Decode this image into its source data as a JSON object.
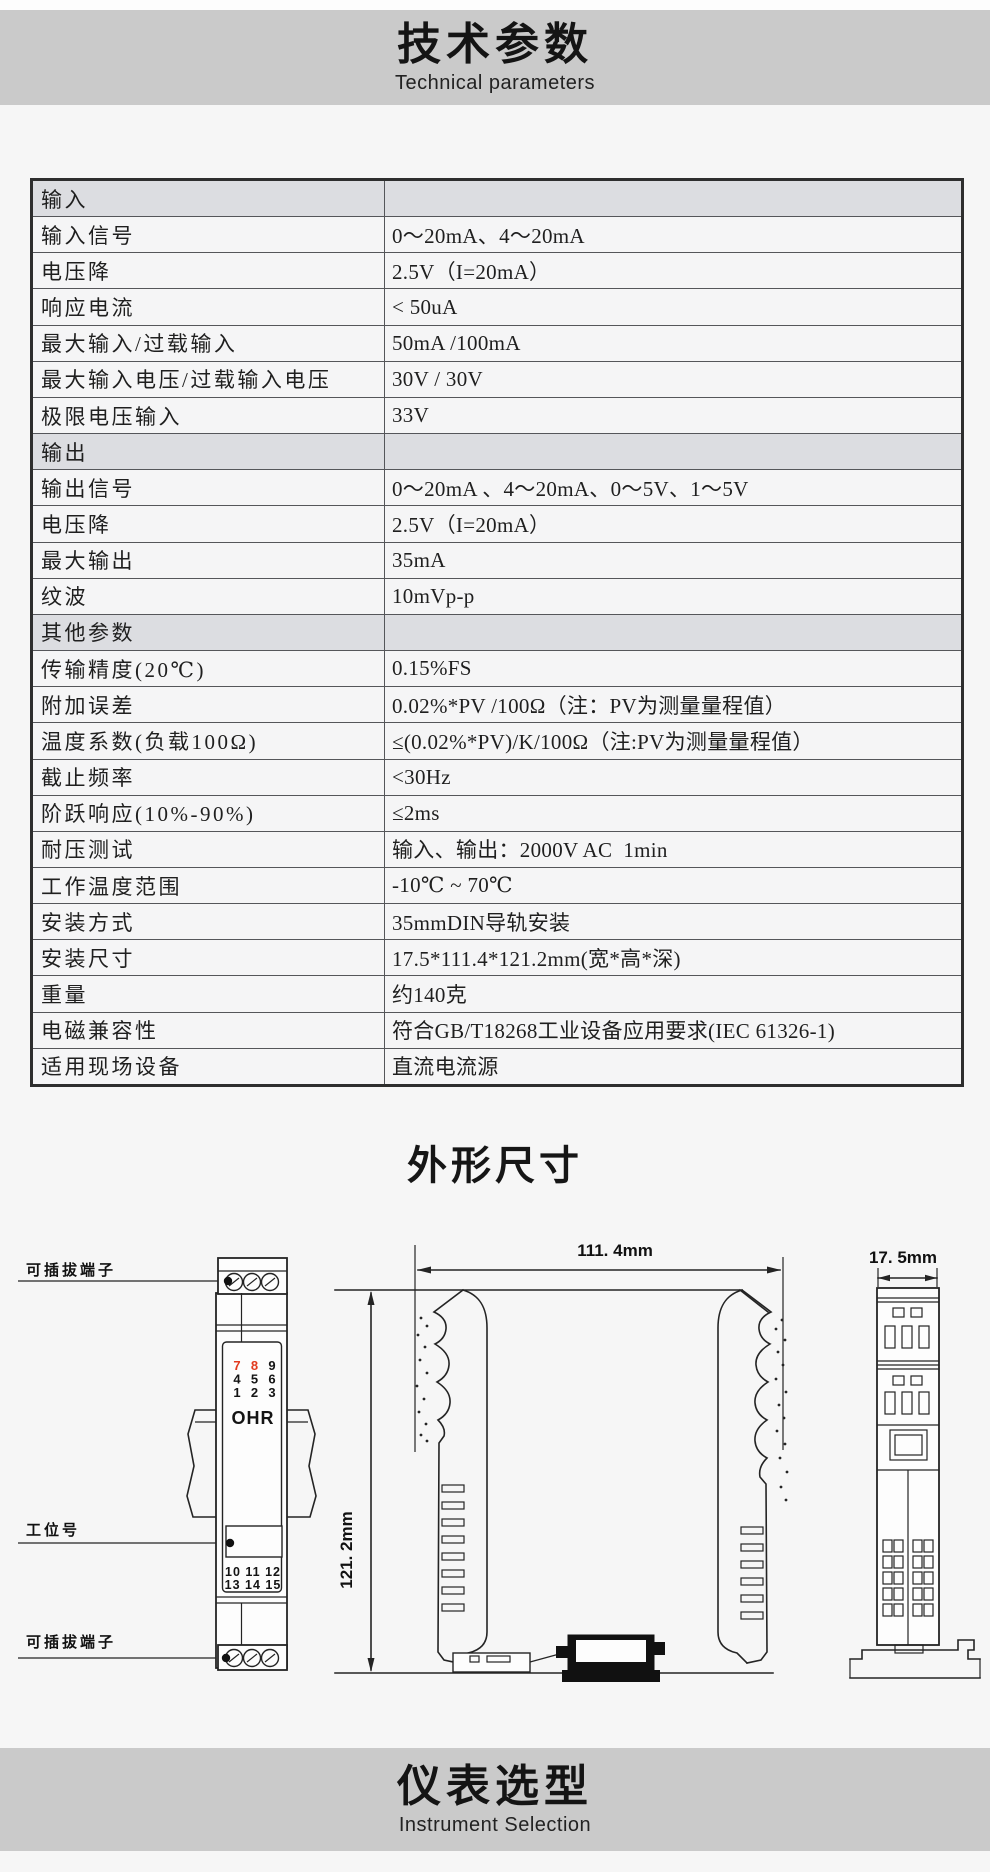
{
  "colors": {
    "page-bg": "#f6f6f6",
    "banner-bg": "#cacaca",
    "row-bg": "#f5f5f6",
    "section-bg": "#dcdde1",
    "line": "#55565a",
    "heavy": "#2e2e2e",
    "red": "#e23a1e",
    "draw": "#242424",
    "ink": "#1c1c1c"
  },
  "header": {
    "title": "技术参数",
    "subtitle": "Technical parameters"
  },
  "outline_section": {
    "title": "外形尺寸"
  },
  "selection_section": {
    "title": "仪表选型",
    "subtitle": "Instrument Selection"
  },
  "spec_table": {
    "rows": [
      {
        "type": "section",
        "label": "输入",
        "value": ""
      },
      {
        "type": "data",
        "label": "输入信号",
        "value": "0～20mA、4～20mA"
      },
      {
        "type": "data",
        "label": "电压降",
        "value": "2.5V（I=20mA）"
      },
      {
        "type": "data",
        "label": "响应电流",
        "value": "< 50uA"
      },
      {
        "type": "data",
        "label": "最大输入/过载输入",
        "value": "50mA /100mA"
      },
      {
        "type": "data",
        "label": "最大输入电压/过载输入电压",
        "value": "30V / 30V"
      },
      {
        "type": "data",
        "label": "极限电压输入",
        "value": "33V"
      },
      {
        "type": "section",
        "label": "输出",
        "value": ""
      },
      {
        "type": "data",
        "label": "输出信号",
        "value": "0～20mA 、4～20mA、0～5V、1～5V"
      },
      {
        "type": "data",
        "label": "电压降",
        "value": "2.5V（I=20mA）"
      },
      {
        "type": "data",
        "label": "最大输出",
        "value": "35mA"
      },
      {
        "type": "data",
        "label": "纹波",
        "value": "10mVp-p"
      },
      {
        "type": "section",
        "label": "其他参数",
        "value": ""
      },
      {
        "type": "data",
        "label": "传输精度(20℃)",
        "value": "0.15%FS"
      },
      {
        "type": "data",
        "label": "附加误差",
        "value": "0.02%*PV /100Ω（注：PV为测量量程值）"
      },
      {
        "type": "data",
        "label": "温度系数(负载100Ω)",
        "value": "≤(0.02%*PV)/K/100Ω（注:PV为测量量程值）"
      },
      {
        "type": "data",
        "label": "截止频率",
        "value": "<30Hz"
      },
      {
        "type": "data",
        "label": "阶跃响应(10%-90%)",
        "value": "≤2ms"
      },
      {
        "type": "data",
        "label": "耐压测试",
        "value": "输入、输出：2000V AC  1min"
      },
      {
        "type": "data",
        "label": "工作温度范围",
        "value": "-10℃ ~ 70℃"
      },
      {
        "type": "data",
        "label": "安装方式",
        "value": "35mmDIN导轨安装"
      },
      {
        "type": "data",
        "label": "安装尺寸",
        "value": "17.5*111.4*121.2mm(宽*高*深)"
      },
      {
        "type": "data",
        "label": "重量",
        "value": "约140克"
      },
      {
        "type": "data",
        "label": "电磁兼容性",
        "value": "符合GB/T18268工业设备应用要求(IEC 61326-1)"
      },
      {
        "type": "data",
        "label": "适用现场设备",
        "value": "直流电流源"
      }
    ]
  },
  "drawings": {
    "front_view": {
      "label_top_terminal": "可插拔端子",
      "label_tag": "工位号",
      "label_bottom_terminal": "可插拔端子",
      "brand": "OHR",
      "numbers_top": [
        "7",
        "8",
        "9",
        "4",
        "5",
        "6",
        "1",
        "2",
        "3"
      ],
      "numbers_bottom_line1": "10 11 12",
      "numbers_bottom_line2": "13 14 15"
    },
    "side_view": {
      "width_dim": "111. 4mm",
      "depth_dim": "121. 2mm"
    },
    "end_view": {
      "width_dim": "17. 5mm"
    }
  }
}
